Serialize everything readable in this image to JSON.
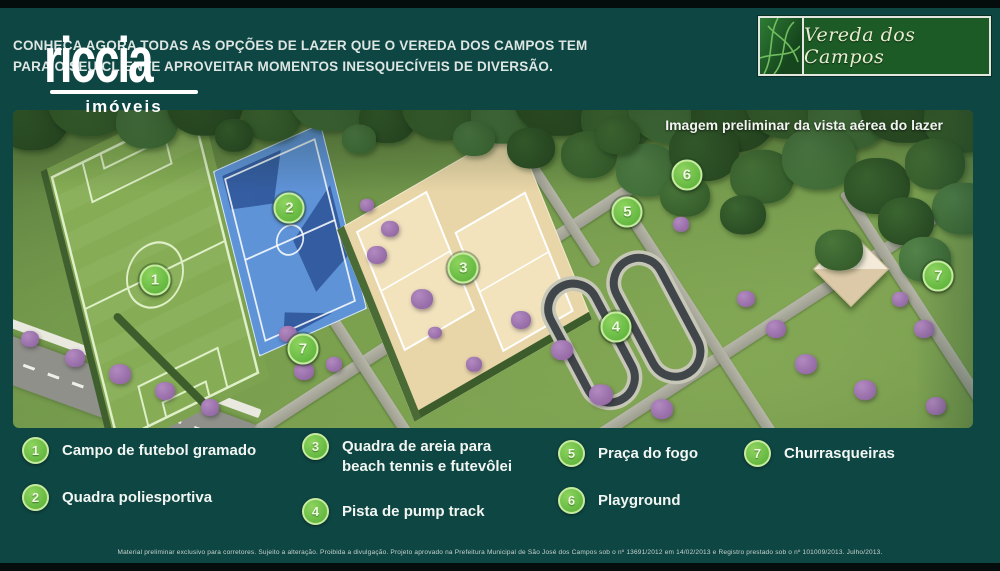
{
  "header": {
    "headline_line1": "CONHEÇA AGORA TODAS AS OPÇÕES DE LAZER QUE O VEREDA DOS CAMPOS TEM",
    "headline_line2": "PARA O SEU CLIENTE APROVEITAR MOMENTOS INESQUECÍVEIS  DE DIVERSÃO.",
    "agency_logo": {
      "name": "riccia",
      "subtitle": "imóveis"
    },
    "brand": {
      "name": "Vereda dos Campos"
    }
  },
  "map": {
    "caption": "Imagem preliminar da vista aérea do lazer",
    "markers": [
      {
        "n": "1",
        "x": 14.8,
        "y": 53.5
      },
      {
        "n": "2",
        "x": 28.8,
        "y": 30.8
      },
      {
        "n": "3",
        "x": 46.9,
        "y": 49.7
      },
      {
        "n": "4",
        "x": 62.8,
        "y": 68.2
      },
      {
        "n": "5",
        "x": 64.0,
        "y": 32.1
      },
      {
        "n": "6",
        "x": 70.2,
        "y": 20.4
      },
      {
        "n": "7",
        "x": 30.2,
        "y": 75.2
      },
      {
        "n": "7",
        "x": 96.4,
        "y": 52.2
      }
    ]
  },
  "legend": {
    "items": [
      {
        "n": "1",
        "label": "Campo de futebol gramado"
      },
      {
        "n": "2",
        "label": "Quadra poliesportiva"
      },
      {
        "n": "3",
        "label": "Quadra de areia para beach tennis e futevôlei"
      },
      {
        "n": "4",
        "label": "Pista de pump track"
      },
      {
        "n": "5",
        "label": "Praça do fogo"
      },
      {
        "n": "6",
        "label": "Playground"
      },
      {
        "n": "7",
        "label": "Churrasqueiras"
      }
    ]
  },
  "footer": {
    "disclaimer": "Material preliminar exclusivo para corretores. Sujeito a alteração. Proibida a divulgação. Projeto aprovado na Prefeitura Municipal de São José dos Campos sob o nº 13691/2012 em 14/02/2013 e Registro prestado sob o nº 101009/2013. Julho/2013."
  },
  "colors": {
    "background": "#0e4643",
    "marker_green": "#54ad35",
    "brand_box_green": "#1c5a26",
    "court_blue": "#5f93d8",
    "sand_beige": "#e9d6a8"
  }
}
